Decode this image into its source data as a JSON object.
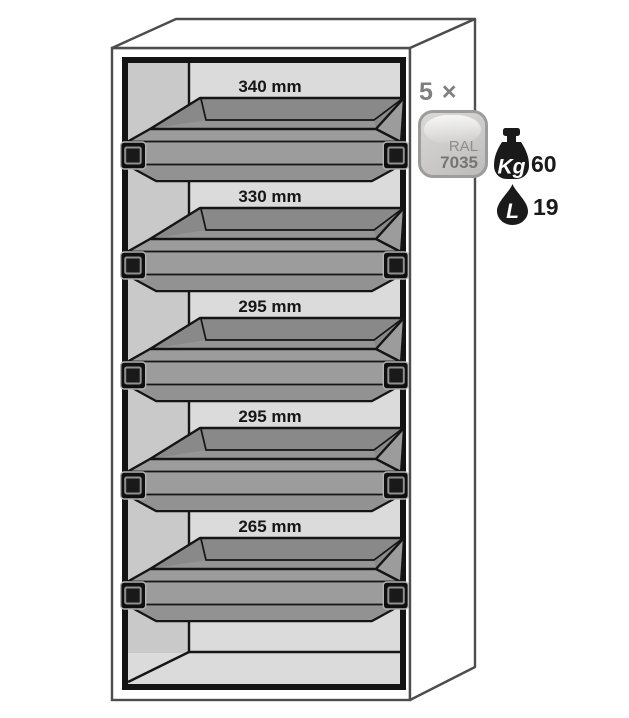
{
  "cabinet": {
    "trays": [
      {
        "width_label": "340 mm"
      },
      {
        "width_label": "330 mm"
      },
      {
        "width_label": "295 mm"
      },
      {
        "width_label": "295 mm"
      },
      {
        "width_label": "265 mm"
      }
    ]
  },
  "legend": {
    "quantity_label": "5 ×",
    "ral_swatch": {
      "prefix": "RAL",
      "code": "7035"
    },
    "max_load": {
      "icon": "weight-icon",
      "unit": "Kg",
      "value": "60"
    },
    "sump_volume": {
      "icon": "drop-icon",
      "unit": "L",
      "value": "19"
    }
  },
  "colors": {
    "cabinet_outline": "#4d4d4d",
    "frame": "#141414",
    "interior_back_wall": "#dbdbdb",
    "interior_side_wall": "#c9c9c9",
    "tray_body": "#9c9c9c",
    "tray_interior": "#898989",
    "label_text": "#161616",
    "quantity_text": "#7f7f7f",
    "swatch_fill": "#cccbc9",
    "swatch_border": "#9c9c9c",
    "icon_fill": "#1a1a1a"
  }
}
